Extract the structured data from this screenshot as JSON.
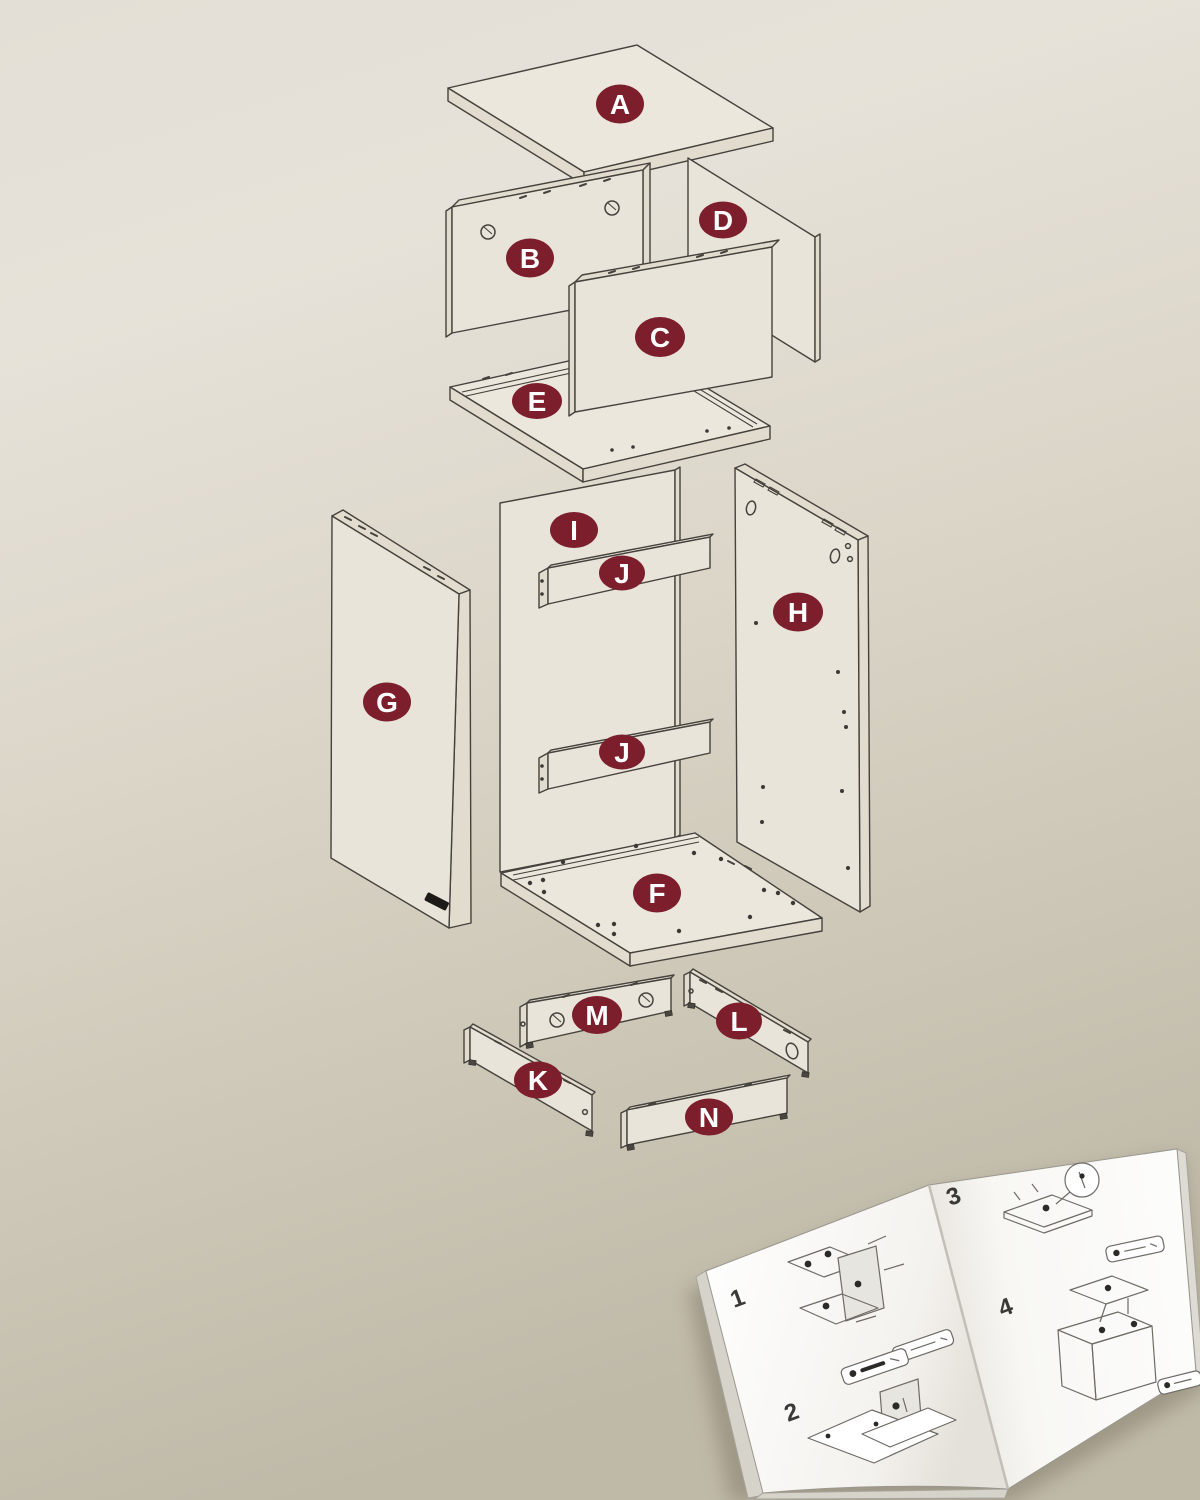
{
  "diagram": {
    "description": "Exploded furniture assembly diagram",
    "parts": [
      {
        "label": "A"
      },
      {
        "label": "B"
      },
      {
        "label": "C"
      },
      {
        "label": "D"
      },
      {
        "label": "E"
      },
      {
        "label": "F"
      },
      {
        "label": "G"
      },
      {
        "label": "H"
      },
      {
        "label": "I"
      },
      {
        "label": "J"
      },
      {
        "label": "J"
      },
      {
        "label": "K"
      },
      {
        "label": "L"
      },
      {
        "label": "M"
      },
      {
        "label": "N"
      }
    ]
  },
  "booklet": {
    "steps": [
      {
        "number": "1"
      },
      {
        "number": "2"
      },
      {
        "number": "3"
      },
      {
        "number": "4"
      }
    ]
  },
  "colors": {
    "label_bg": "#7c1e2b",
    "label_text": "#ffffff",
    "line": "#45423d",
    "panel_fill": "#e9e4d9",
    "background_top": "#e5e1d8",
    "background_bottom": "#c0baa9",
    "page": "#fbfaf8"
  }
}
